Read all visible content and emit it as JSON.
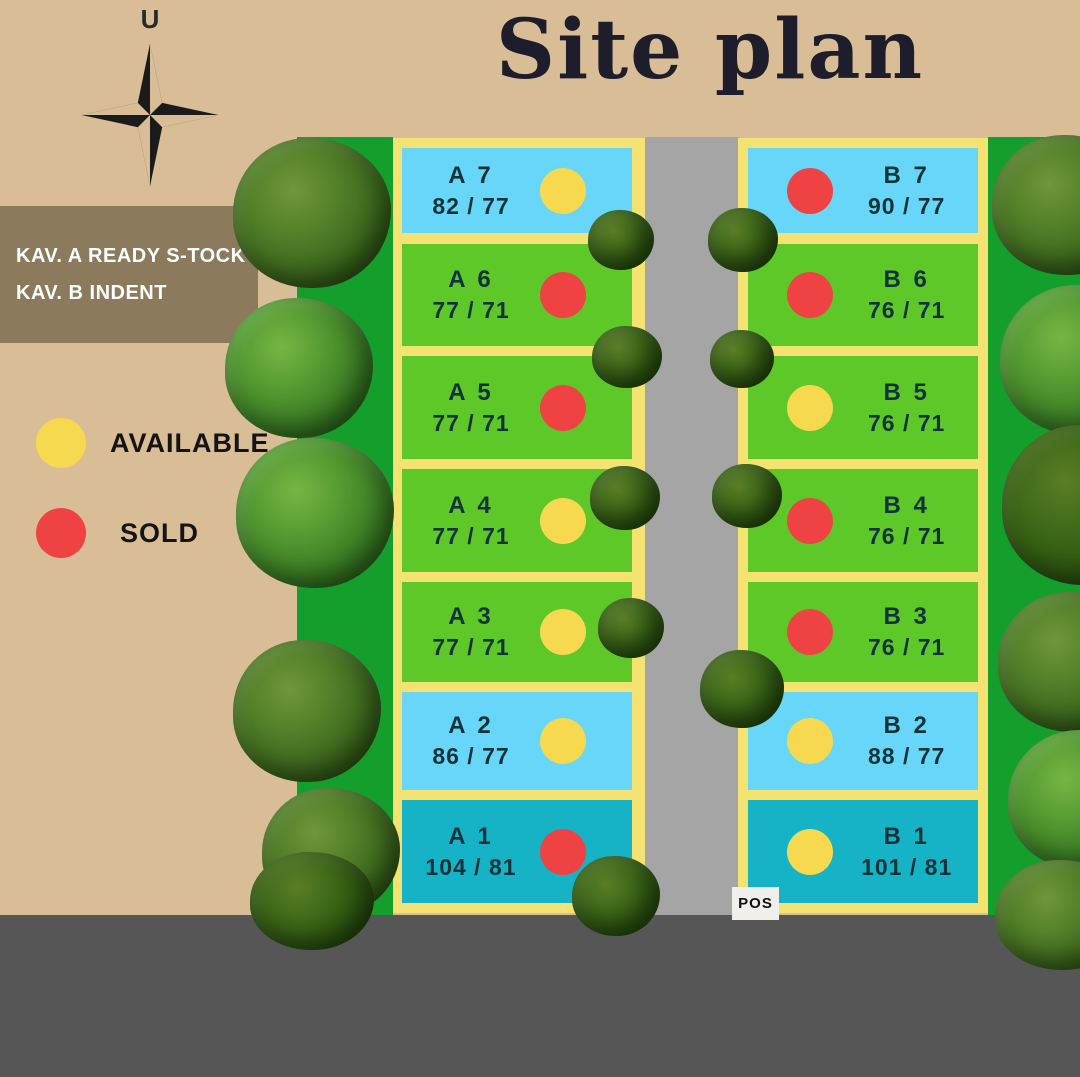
{
  "title": "Site plan",
  "compass": {
    "north_label": "U"
  },
  "info_box": {
    "line1": "KAV. A READY S-TOCK",
    "line2": "KAV. B INDENT"
  },
  "legend": {
    "available_label": "AVAILABLE",
    "sold_label": "SOLD"
  },
  "pos_label": "POS",
  "columns": {
    "a": [
      {
        "id": "A 7",
        "size": "82 / 77",
        "status": "available",
        "surface": "blue"
      },
      {
        "id": "A 6",
        "size": "77 / 71",
        "status": "sold",
        "surface": "green"
      },
      {
        "id": "A 5",
        "size": "77 / 71",
        "status": "sold",
        "surface": "green"
      },
      {
        "id": "A 4",
        "size": "77 / 71",
        "status": "available",
        "surface": "green"
      },
      {
        "id": "A 3",
        "size": "77 / 71",
        "status": "available",
        "surface": "green"
      },
      {
        "id": "A 2",
        "size": "86 / 77",
        "status": "available",
        "surface": "blue"
      },
      {
        "id": "A 1",
        "size": "104 / 81",
        "status": "sold",
        "surface": "teal"
      }
    ],
    "b": [
      {
        "id": "B 7",
        "size": "90 / 77",
        "status": "sold",
        "surface": "blue"
      },
      {
        "id": "B 6",
        "size": "76 / 71",
        "status": "sold",
        "surface": "green"
      },
      {
        "id": "B 5",
        "size": "76 / 71",
        "status": "available",
        "surface": "green"
      },
      {
        "id": "B 4",
        "size": "76 / 71",
        "status": "sold",
        "surface": "green"
      },
      {
        "id": "B 3",
        "size": "76 / 71",
        "status": "sold",
        "surface": "green"
      },
      {
        "id": "B 2",
        "size": "88 / 77",
        "status": "available",
        "surface": "blue"
      },
      {
        "id": "B 1",
        "size": "101 / 81",
        "status": "available",
        "surface": "teal"
      }
    ]
  },
  "colors": {
    "available": "#f6d94e",
    "sold": "#ef4343",
    "lot_green": "#5ec829",
    "lot_blue": "#67d6f8",
    "lot_teal": "#16b3c6",
    "border_yellow": "#f4e373",
    "background_tan": "#d9bd96",
    "info_box_brown": "#8b7a5c",
    "road_center_gray": "#a5a5a5",
    "road_bottom_gray": "#575656",
    "greenbelt": "#149f2c"
  }
}
